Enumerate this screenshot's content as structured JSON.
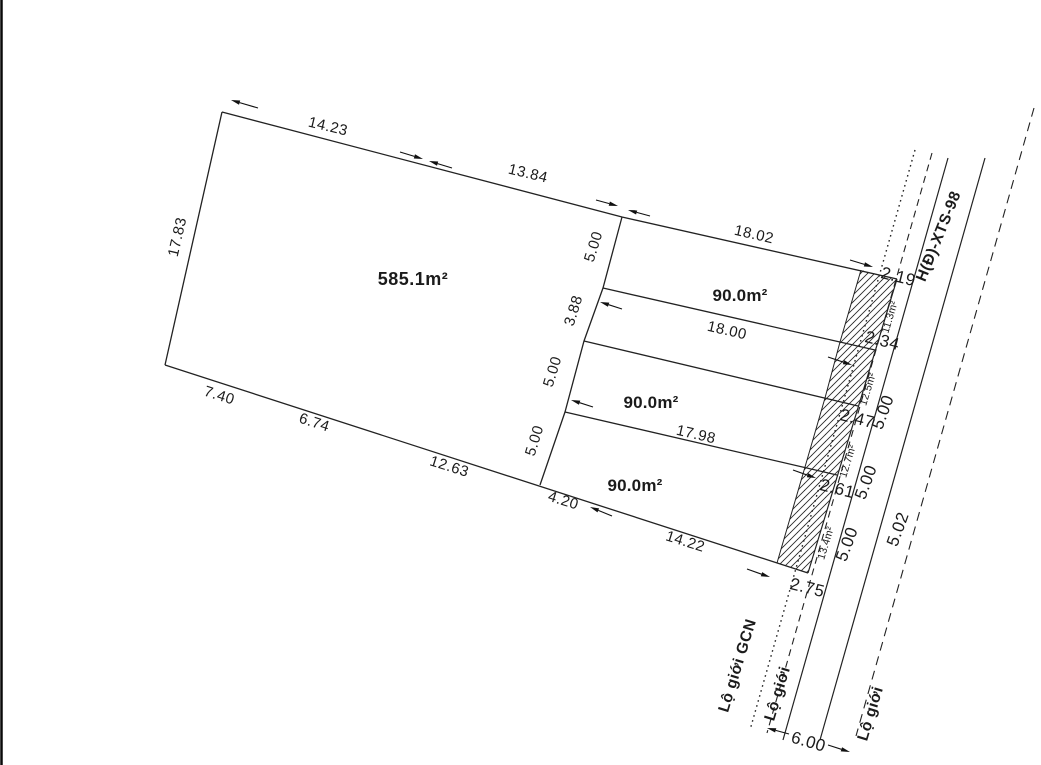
{
  "parcels": {
    "main_area": "585.1m²",
    "lot_areas": [
      "90.0m²",
      "90.0m²",
      "90.0m²"
    ],
    "road_strip_areas": [
      "11.3m²",
      "12.5m²",
      "12.7m²",
      "13.4m²"
    ]
  },
  "dims": {
    "top": [
      "14.23",
      "13.84"
    ],
    "left_edge": "17.83",
    "bottom": [
      "7.40",
      "6.74",
      "12.63",
      "4.20",
      "14.22"
    ],
    "column": [
      "5.00",
      "3.88",
      "5.00",
      "5.00"
    ],
    "lot_edges": [
      "18.02",
      "18.00",
      "17.98"
    ],
    "strip_ticks": [
      "2.19",
      "2.34",
      "2.47",
      "2.61",
      "2.75"
    ],
    "road_widths": [
      "5.00",
      "5.00",
      "5.00",
      "5.02"
    ],
    "road_total_width": "6.00"
  },
  "road": {
    "name": "H(Đ)-XTS-98",
    "gcn_boundary_label": "Lộ giới GCN",
    "boundary_labels": [
      "Lộ giới",
      "Lộ giới"
    ]
  }
}
